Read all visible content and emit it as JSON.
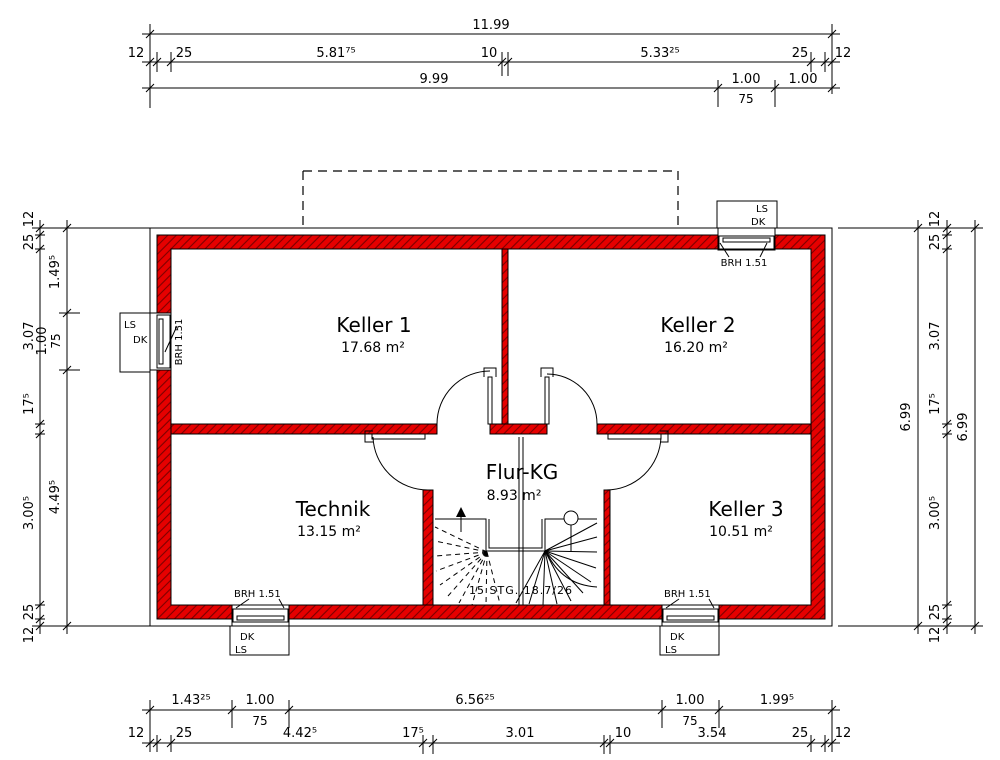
{
  "rooms": {
    "keller1": {
      "name": "Keller 1",
      "area": "17.68 m²"
    },
    "keller2": {
      "name": "Keller 2",
      "area": "16.20 m²"
    },
    "technik": {
      "name": "Technik",
      "area": "13.15 m²"
    },
    "flur": {
      "name": "Flur-KG",
      "area": "8.93 m²"
    },
    "keller3": {
      "name": "Keller 3",
      "area": "10.51 m²"
    }
  },
  "stair": {
    "label": "15 STG. 18.7/26"
  },
  "window_labels": {
    "ls": "LS",
    "dk": "DK",
    "brh": "BRH 1.51"
  },
  "dims": {
    "top_total": "11.99",
    "top_chain": [
      "12",
      "25",
      "5.81⁷⁵",
      "10",
      "5.33²⁵",
      "25",
      "12"
    ],
    "top_sub": [
      "9.99",
      "1.00",
      "1.00"
    ],
    "top_sub_75": "75",
    "bottom_upper": [
      "1.43²⁵",
      "1.00",
      "6.56²⁵",
      "1.00",
      "1.99⁵"
    ],
    "bottom_upper_75": [
      "75",
      "75"
    ],
    "bottom_lower": [
      "12",
      "25",
      "4.42⁵",
      "17⁵",
      "3.01",
      "10",
      "3.54",
      "25",
      "12"
    ],
    "left_chain": [
      "12",
      "25",
      "3.07",
      "17⁵",
      "3.00⁵",
      "25",
      "12"
    ],
    "left_inner": [
      "1.49⁵",
      "1.00",
      "4.49⁵"
    ],
    "left_inner_75": "75",
    "right_chain": [
      "12",
      "25",
      "3.07",
      "17⁵",
      "3.00⁵",
      "25",
      "12"
    ],
    "right_total_inner": "6.99",
    "right_total_outer": "6.99"
  },
  "colors": {
    "wall_fill": "#e60000",
    "wall_hatch": "#7d0000",
    "line": "#000000"
  }
}
